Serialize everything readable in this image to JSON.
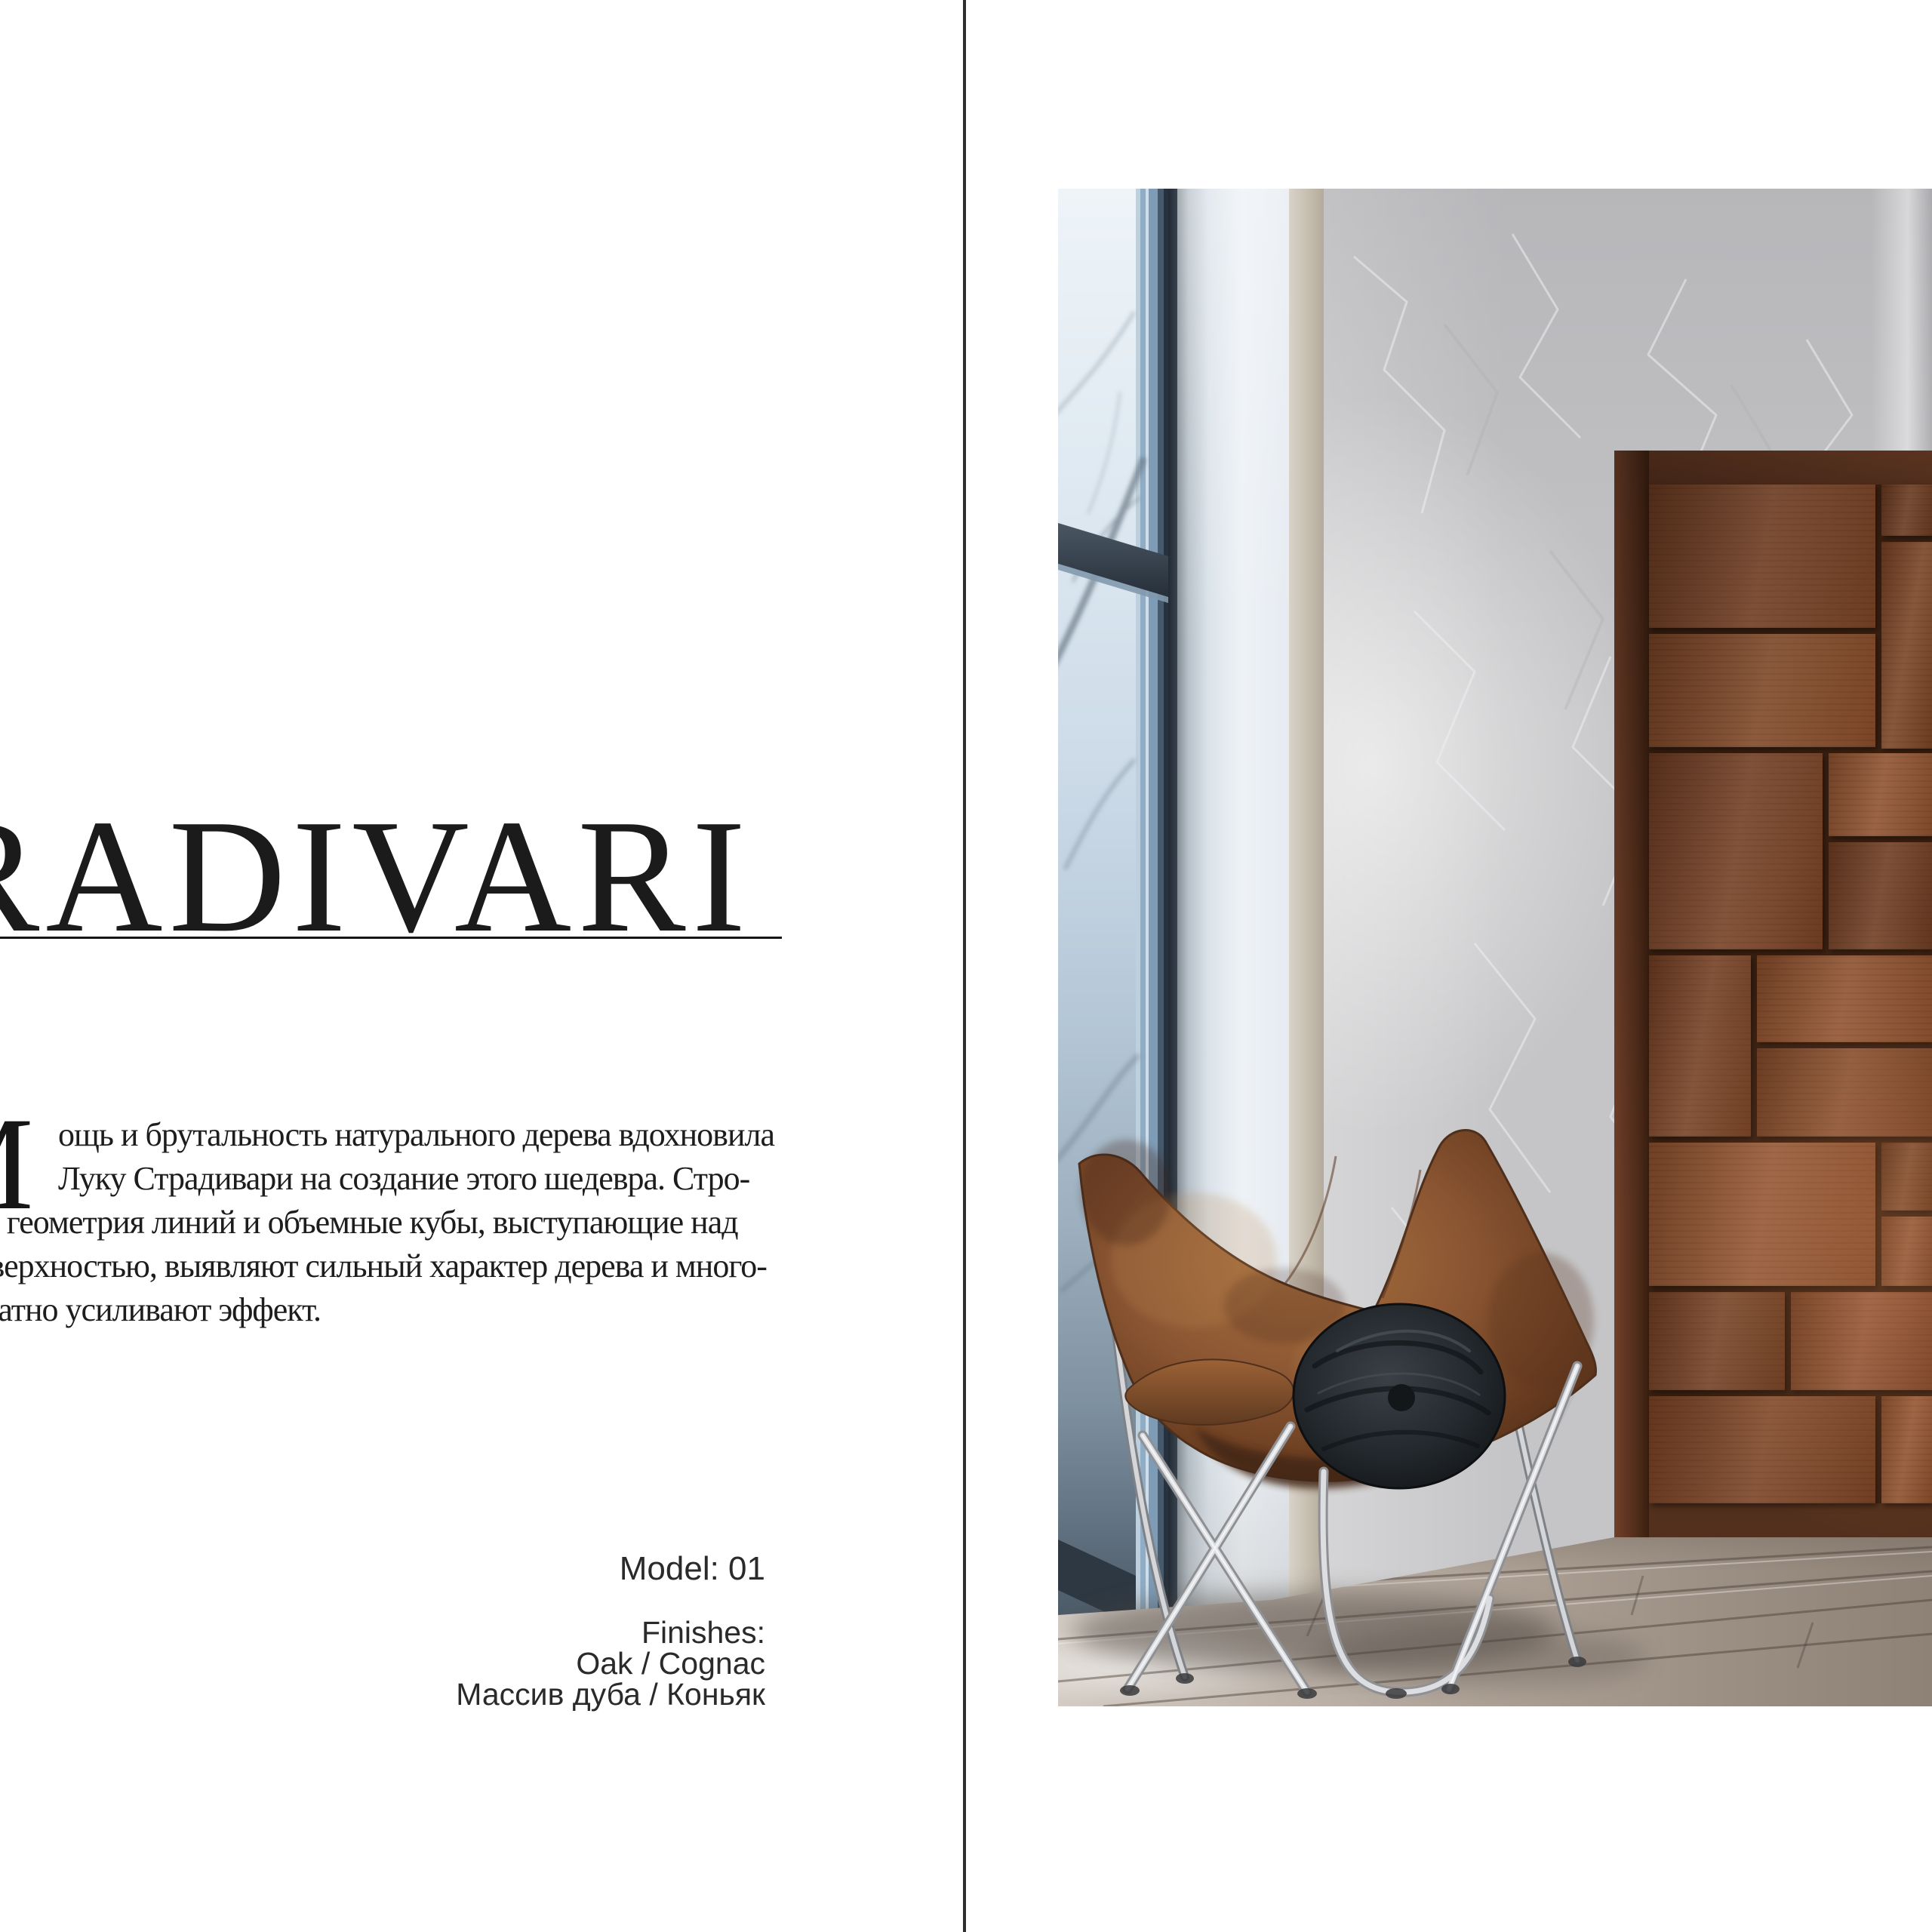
{
  "page": {
    "background": "#ffffff"
  },
  "left_page": {
    "title": {
      "text": "STRADIVARI",
      "color": "#1b1b1b",
      "underline_color": "#161616"
    },
    "paragraph": {
      "drop_cap": "М",
      "lines": [
        "ощь и брутальность натурального дерева вдохновила",
        "Луку Страдивари на создание этого шедевра. Стро-",
        "гая геометрия линий и объемные кубы, выступающие над",
        "поверхностью, выявляют сильный характер дерева и много-",
        "кратно усиливают эффект."
      ],
      "color": "#1d1d1d"
    },
    "specs": {
      "model": "Model: 01",
      "finishes_label": "Finishes:",
      "finish_en": "Oak / Cognac",
      "finish_ru": "Массив дуба / Коньяк",
      "color": "#2a2a2a"
    }
  },
  "divider": {
    "color": "#2e2e2e"
  },
  "photo": {
    "description": "Interior photo: frosted window with tree branches, white wall corner, gray decorative plaster wall, cognac oak door with protruding cube panels, worn leather butterfly chair with round black quilted pillow, weathered gray wood plank floor",
    "colors": {
      "door_wood": "#7f4627",
      "door_frame": "#502c1a",
      "plaster_wall": "#c5c5c7",
      "white_wall": "#eef2f6",
      "beige_strip": "#c6beb0",
      "glass_top": "#eef4f8",
      "glass_bottom": "#39454f",
      "window_frame_blue": "#8fadc6",
      "window_mullion": "#232c36",
      "floor": "#aea297",
      "chair_leather": "#8a5532",
      "pillow": "#23282d",
      "chrome": "#d9dbde"
    }
  }
}
